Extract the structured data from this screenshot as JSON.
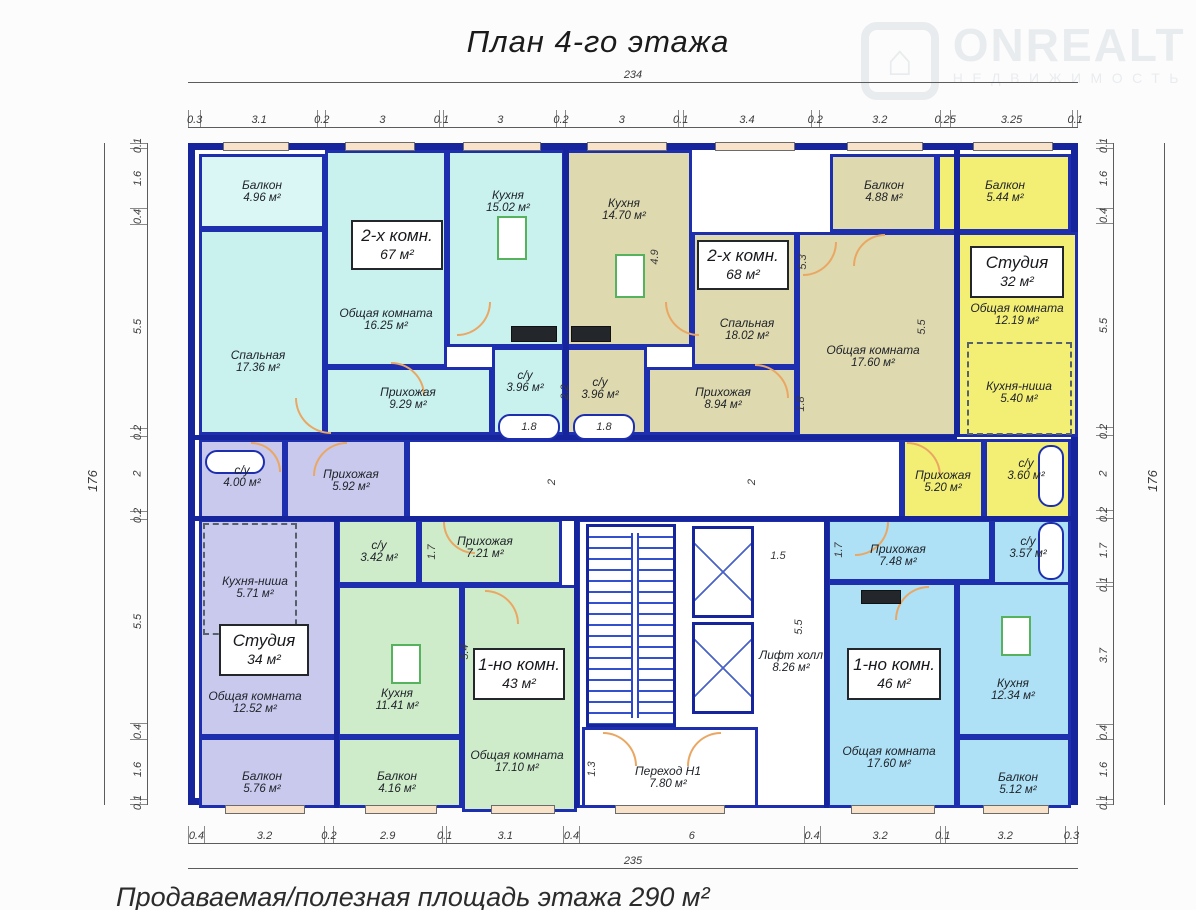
{
  "title": "План 4-го этажа",
  "footer": "Продаваемая/полезная площадь этажа  290 м²",
  "logo": {
    "brand": "ONREALT",
    "subtitle": "НЕДВИЖИМОСТЬ",
    "house_glyph": "⌂"
  },
  "totals": {
    "top": "234",
    "bottom": "235",
    "left": "176",
    "right": "176"
  },
  "dims": {
    "top": [
      "0.3",
      "3.1",
      "0.2",
      "3",
      "0.1",
      "3",
      "0.2",
      "3",
      "0.1",
      "3.4",
      "0.2",
      "3.2",
      "0.25",
      "3.25",
      "0.1"
    ],
    "bottom": [
      "0.4",
      "3.2",
      "0.2",
      "2.9",
      "0.1",
      "3.1",
      "0.4",
      "6",
      "0.4",
      "3.2",
      "0.1",
      "3.2",
      "0.3"
    ],
    "left": [
      "0.1",
      "1.6",
      "0.4",
      "5.5",
      "0.2",
      "2",
      "0.2",
      "5.5",
      "0.4",
      "1.6",
      "0.1"
    ],
    "right": [
      "0.1",
      "1.6",
      "0.4",
      "5.5",
      "0.2",
      "2",
      "0.2",
      "1.7",
      "0.1",
      "3.7",
      "0.4",
      "1.6",
      "0.1"
    ]
  },
  "interior_dims": [
    "4.9",
    "5.3",
    "5.5",
    "2.2",
    "1.8",
    "1.8",
    "2",
    "2",
    "1.7",
    "5.4",
    "1.5",
    "5.5",
    "1.3",
    "1.7",
    "1.8"
  ],
  "apartments": [
    {
      "badge": [
        "2-х комн.",
        "67 м²"
      ],
      "rooms": [
        {
          "name": "Балкон",
          "area": "4.96 м²"
        },
        {
          "name": "Спальная",
          "area": "17.36 м²"
        },
        {
          "name": "Общая комната",
          "area": "16.25 м²"
        },
        {
          "name": "Кухня",
          "area": "15.02 м²"
        },
        {
          "name": "Прихожая",
          "area": "9.29 м²"
        },
        {
          "name": "с/у",
          "area": "3.96 м²"
        }
      ]
    },
    {
      "badge": [
        "2-х комн.",
        "68 м²"
      ],
      "rooms": [
        {
          "name": "Кухня",
          "area": "14.70 м²"
        },
        {
          "name": "Спальная",
          "area": "18.02 м²"
        },
        {
          "name": "Общая комната",
          "area": "17.60 м²"
        },
        {
          "name": "Прихожая",
          "area": "8.94 м²"
        },
        {
          "name": "с/у",
          "area": "3.96 м²"
        },
        {
          "name": "Балкон",
          "area": "4.88 м²"
        }
      ]
    },
    {
      "badge": [
        "Студия",
        "32 м²"
      ],
      "rooms": [
        {
          "name": "Общая комната",
          "area": "12.19 м²"
        },
        {
          "name": "Кухня-ниша",
          "area": "5.40 м²"
        },
        {
          "name": "Прихожая",
          "area": "5.20 м²"
        },
        {
          "name": "с/у",
          "area": "3.60 м²"
        },
        {
          "name": "Балкон",
          "area": "5.44 м²"
        }
      ]
    },
    {
      "badge": [
        "Студия",
        "34 м²"
      ],
      "rooms": [
        {
          "name": "с/у",
          "area": "4.00 м²"
        },
        {
          "name": "Прихожая",
          "area": "5.92 м²"
        },
        {
          "name": "Кухня-ниша",
          "area": "5.71 м²"
        },
        {
          "name": "Общая комната",
          "area": "12.52 м²"
        },
        {
          "name": "Балкон",
          "area": "5.76 м²"
        }
      ]
    },
    {
      "badge": [
        "1-но комн.",
        "43 м²"
      ],
      "rooms": [
        {
          "name": "с/у",
          "area": "3.42 м²"
        },
        {
          "name": "Прихожая",
          "area": "7.21 м²"
        },
        {
          "name": "Кухня",
          "area": "11.41 м²"
        },
        {
          "name": "Общая комната",
          "area": "17.10 м²"
        },
        {
          "name": "Балкон",
          "area": "4.16 м²"
        }
      ]
    },
    {
      "badge": [
        "1-но комн.",
        "46 м²"
      ],
      "rooms": [
        {
          "name": "Прихожая",
          "area": "7.48 м²"
        },
        {
          "name": "с/у",
          "area": "3.57 м²"
        },
        {
          "name": "Кухня",
          "area": "12.34 м²"
        },
        {
          "name": "Общая комната",
          "area": "17.60 м²"
        },
        {
          "name": "Балкон",
          "area": "5.12 м²"
        }
      ]
    }
  ],
  "common": [
    {
      "name": "Лифт холл",
      "area": "8.26 м²"
    },
    {
      "name": "Переход Н1",
      "area": "7.80 м²"
    }
  ]
}
